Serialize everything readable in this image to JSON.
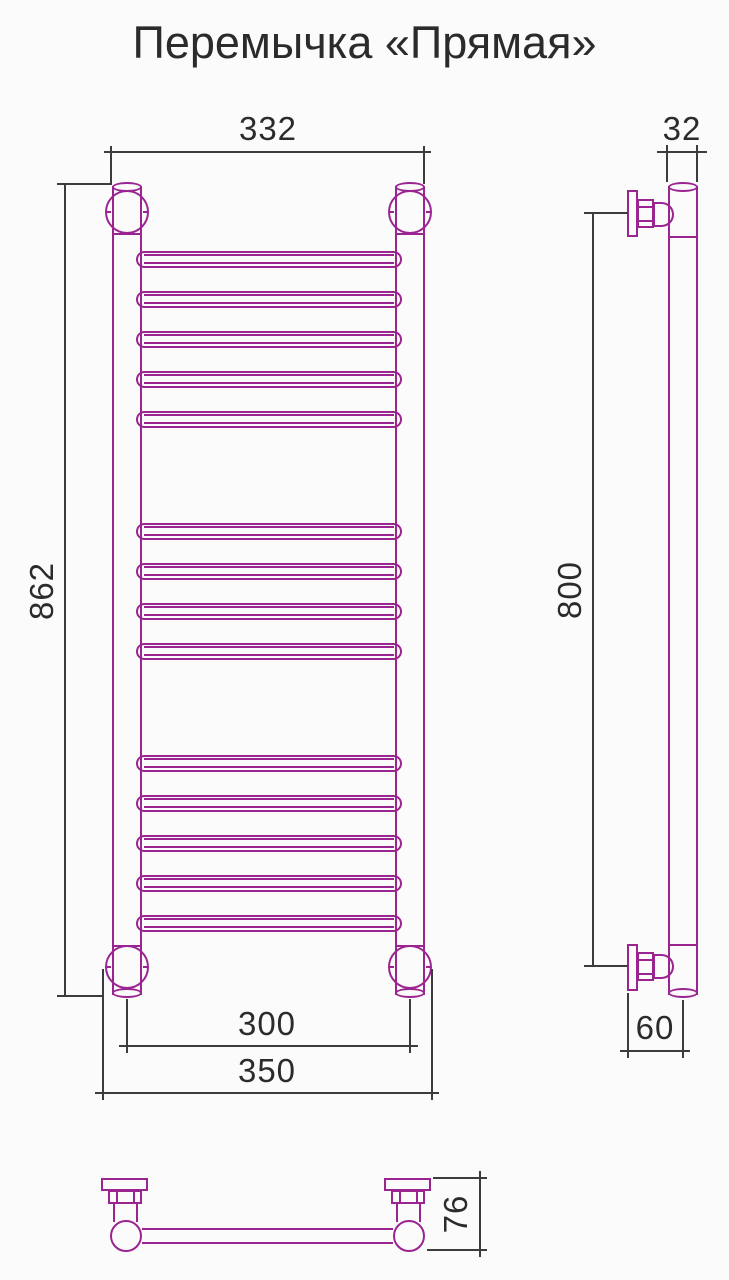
{
  "title": "Перемычка «Прямая»",
  "colors": {
    "outline": "#9A2490",
    "dimension_line": "#3C3C3C",
    "text": "#2B2B2B",
    "background": "#FBFBFB"
  },
  "dimensions": {
    "top_width": "332",
    "side_tube_width": "32",
    "front_height": "862",
    "side_mount_height": "800",
    "bottom_center_distance": "300",
    "bottom_outer_width": "350",
    "wall_to_axis": "60",
    "depth": "76"
  },
  "front_view": {
    "rung_centers_y": [
      259,
      299,
      339,
      379,
      419,
      531,
      571,
      611,
      651,
      763,
      803,
      843,
      883,
      923
    ]
  }
}
